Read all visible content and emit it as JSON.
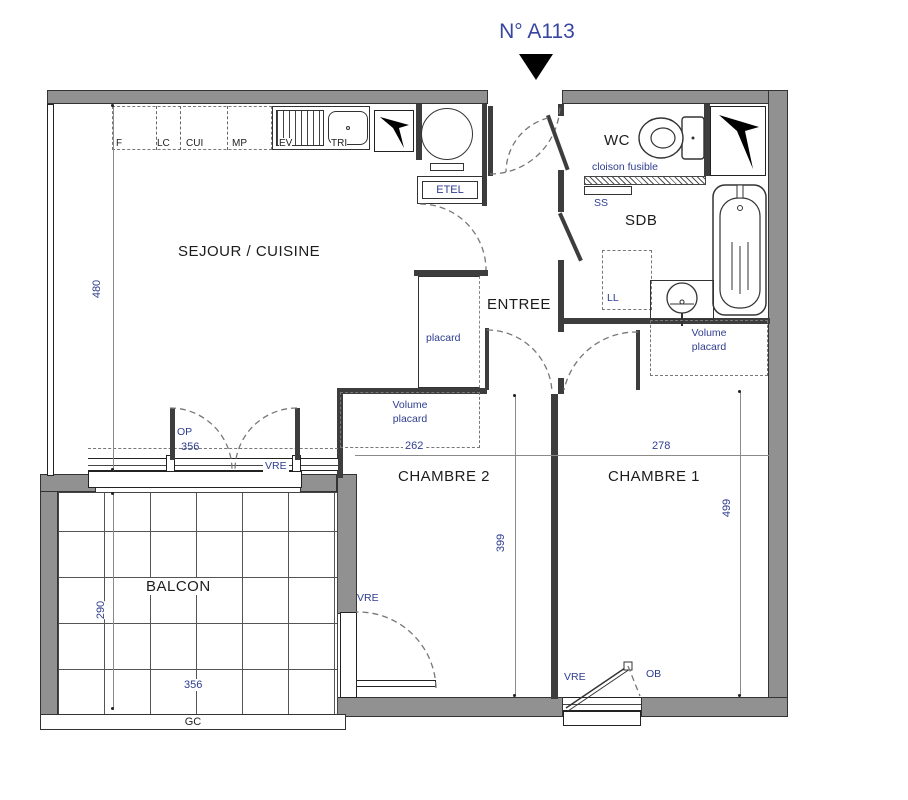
{
  "title": "N° A113",
  "rooms": {
    "sejour": "SEJOUR / CUISINE",
    "entree": "ENTREE",
    "wc": "WC",
    "sdb": "SDB",
    "chambre1": "CHAMBRE 1",
    "chambre2": "CHAMBRE 2",
    "balcon": "BALCON"
  },
  "labels": {
    "cloison_fusible": "cloison fusible",
    "placard": "placard",
    "volume_placard": "Volume placard",
    "etel": "ETEL",
    "ss": "SS",
    "ll": "LL",
    "op": "OP",
    "ob": "OB",
    "gc": "GC",
    "vre": "VRE"
  },
  "kitchen": {
    "f": "F",
    "lc": "LC",
    "cui": "CUI",
    "mp": "MP",
    "ev": "EV",
    "tri": "TRI"
  },
  "dims": {
    "sejour_h": "480",
    "sejour_w": "356",
    "ch2_w": "262",
    "ch1_w": "278",
    "ch1_h": "499",
    "ch2_h": "399",
    "balcon_h": "290",
    "balcon_w": "356"
  },
  "colors": {
    "label_blue": "#2e3d8f",
    "title_blue": "#3946a0",
    "wall_gray": "#919191",
    "line_dark": "#3d3d3d"
  }
}
